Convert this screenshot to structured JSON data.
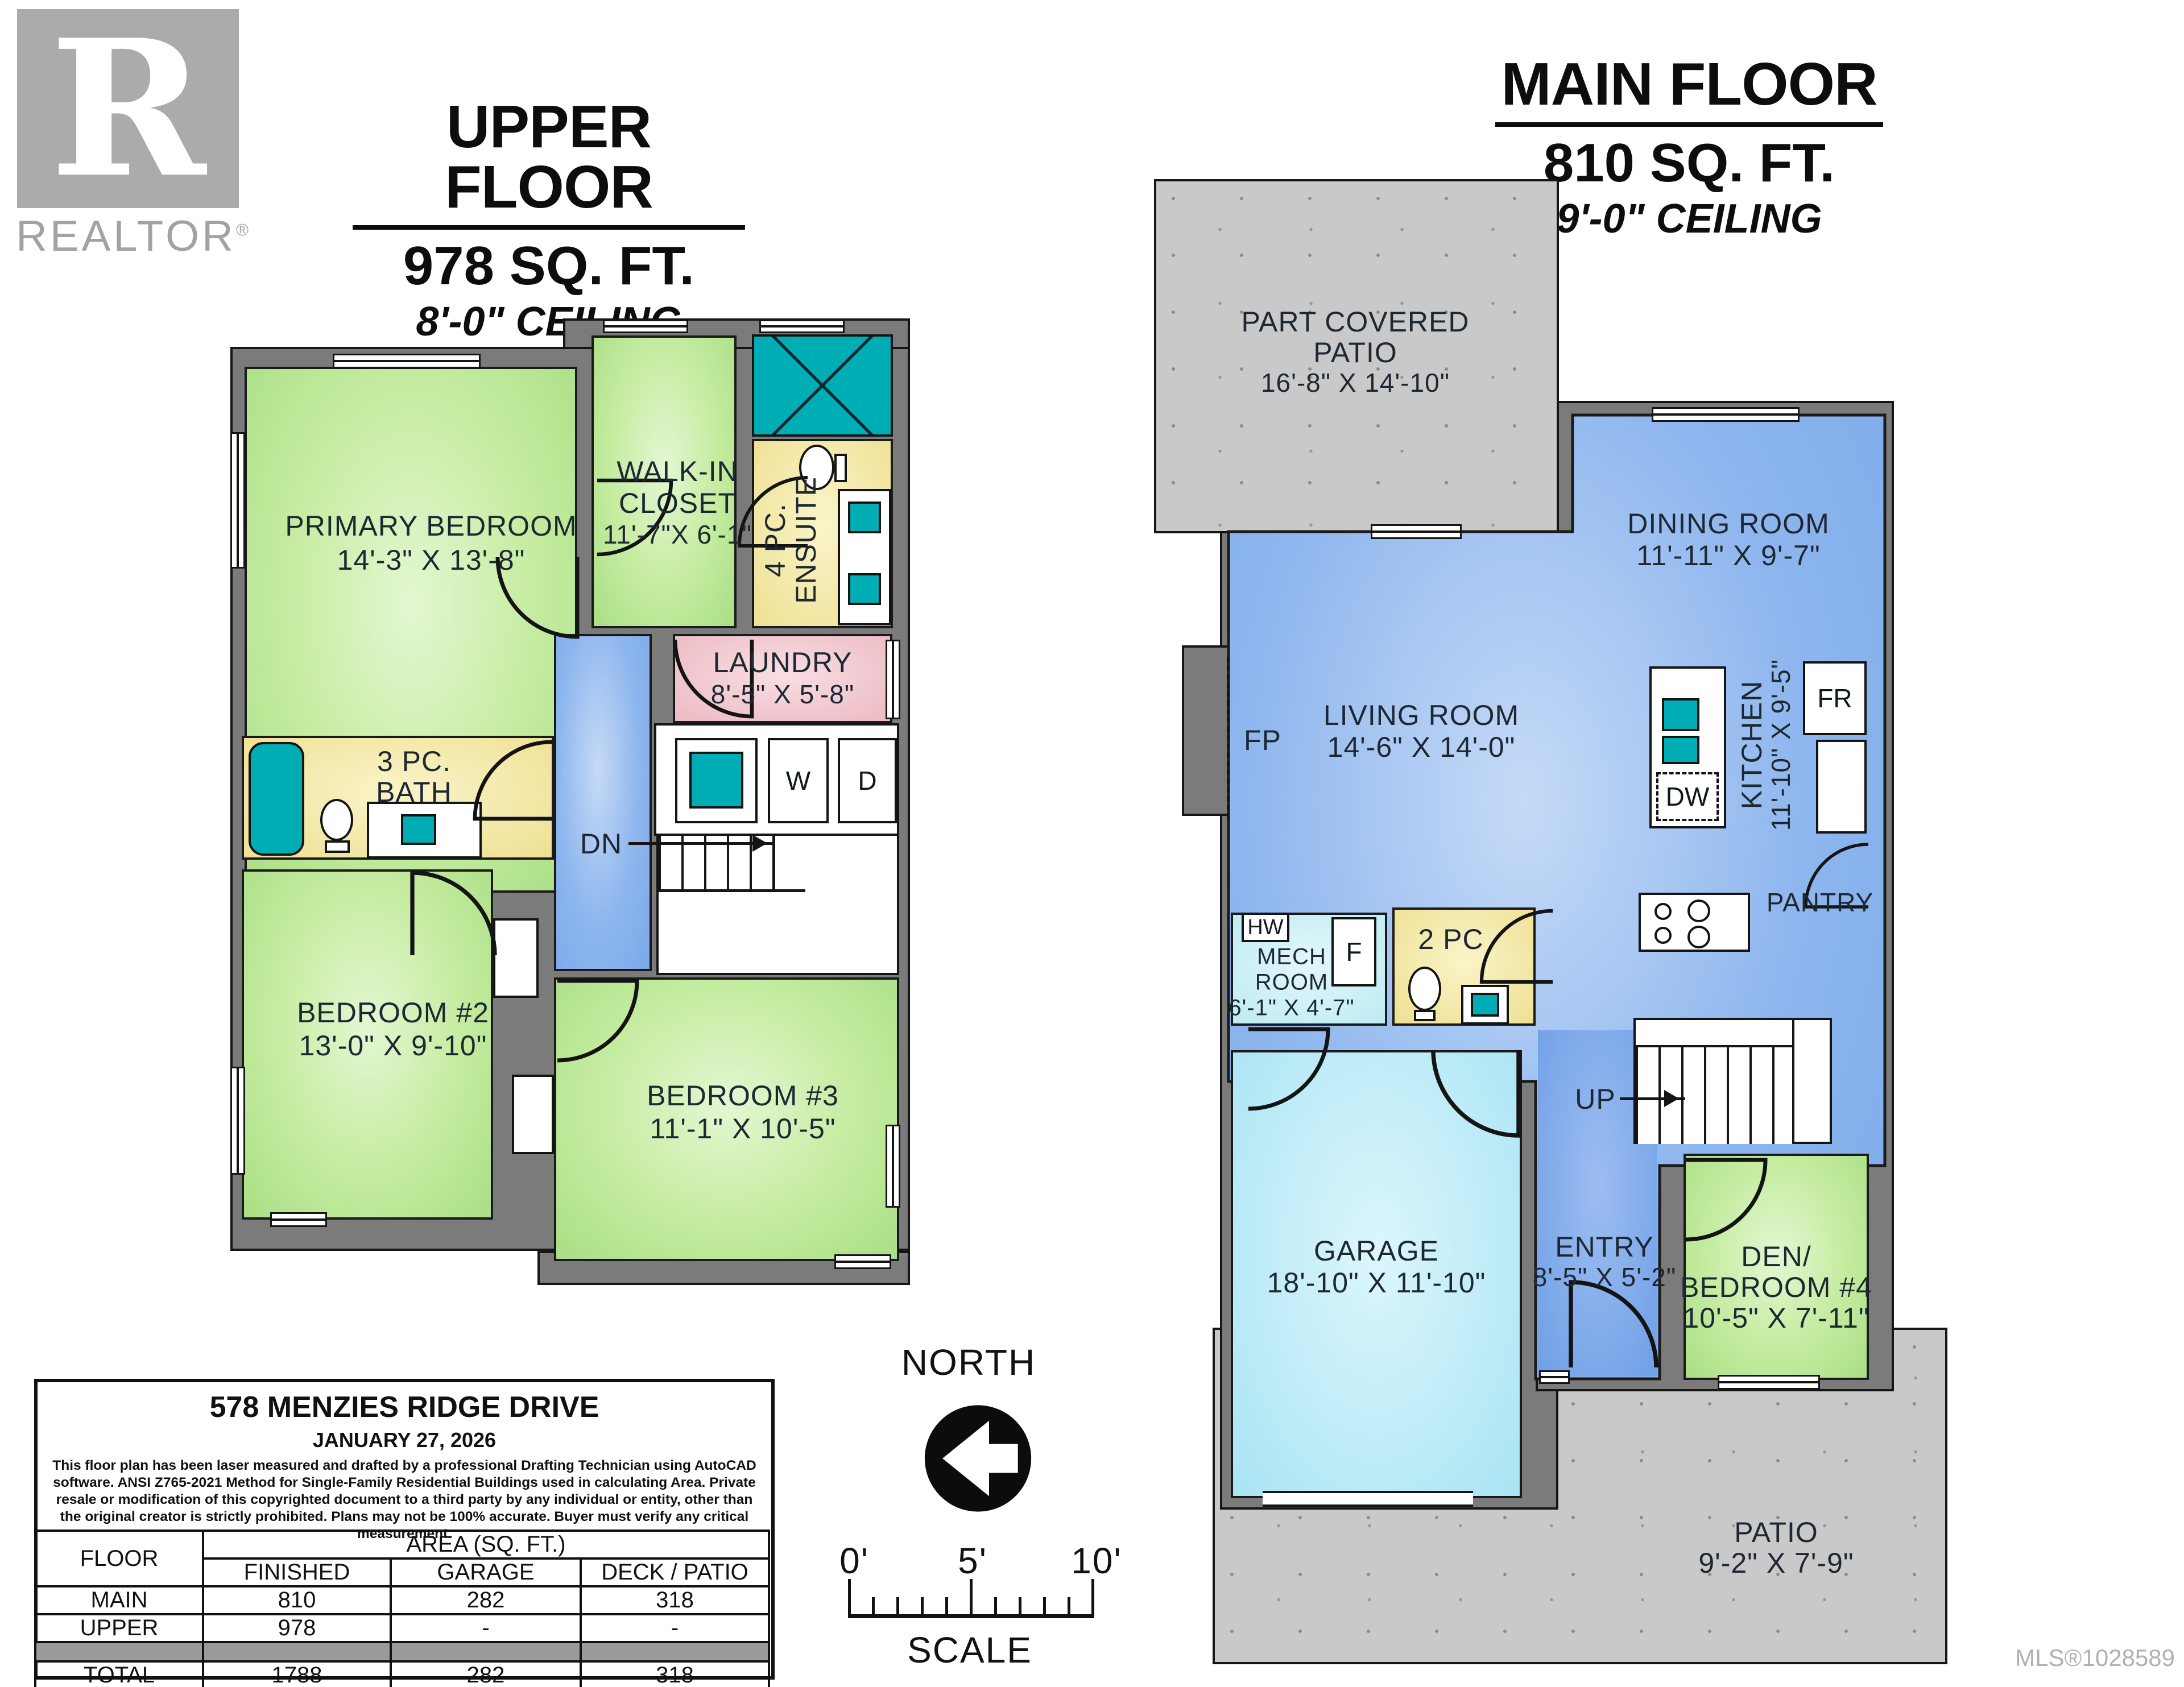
{
  "branding": {
    "logo_letter": "R",
    "brand": "REALTOR",
    "registered": "®"
  },
  "upper": {
    "title": "UPPER FLOOR",
    "area": "978 SQ. FT.",
    "ceiling": "8'-0\" CEILING",
    "rooms": {
      "primary": {
        "name": "PRIMARY BEDROOM",
        "dims": "14'-3\" X 13'-8\""
      },
      "walkin": {
        "line1": "WALK-IN",
        "line2": "CLOSET",
        "dims": "11'-7\"X 6'-1\""
      },
      "ensuite": {
        "line1": "4 PC.",
        "line2": "ENSUITE"
      },
      "laundry": {
        "name": "LAUNDRY",
        "dims": "8'-5\" X 5'-8\""
      },
      "bath": {
        "line1": "3 PC.",
        "line2": "BATH"
      },
      "bedroom2": {
        "name": "BEDROOM #2",
        "dims": "13'-0\" X 9'-10\""
      },
      "bedroom3": {
        "name": "BEDROOM #3",
        "dims": "11'-1\" X 10'-5\""
      }
    },
    "labels": {
      "down": "DN",
      "washer": "W",
      "dryer": "D"
    }
  },
  "main": {
    "title": "MAIN FLOOR",
    "area": "810 SQ. FT.",
    "ceiling": "9'-0\" CEILING",
    "rooms": {
      "covered_patio": {
        "line1": "PART COVERED",
        "line2": "PATIO",
        "dims": "16'-8\" X 14'-10\""
      },
      "dining": {
        "name": "DINING ROOM",
        "dims": "11'-11\" X 9'-7\""
      },
      "living": {
        "name": "LIVING ROOM",
        "dims": "14'-6\" X 14'-0\""
      },
      "kitchen": {
        "name": "KITCHEN",
        "dims": "11'-10\" X 9'-5\""
      },
      "pantry": {
        "name": "PANTRY"
      },
      "mech": {
        "line1": "MECH",
        "line2": "ROOM",
        "dims": "6'-1\" X 4'-7\""
      },
      "powder": {
        "name": "2 PC"
      },
      "garage": {
        "name": "GARAGE",
        "dims": "18'-10\" X 11'-10\""
      },
      "entry": {
        "name": "ENTRY",
        "dims": "8'-5\" X 5'-2\""
      },
      "den": {
        "line1": "DEN/",
        "line2": "BEDROOM #4",
        "dims": "10'-5\" X 7'-11\""
      },
      "patio": {
        "name": "PATIO",
        "dims": "9'-2\" X 7'-9\""
      }
    },
    "labels": {
      "fireplace": "FP",
      "fridge": "FR",
      "dishwasher": "DW",
      "hot_water": "HW",
      "furnace": "F",
      "up": "UP"
    }
  },
  "info": {
    "address": "578 MENZIES RIDGE DRIVE",
    "date": "JANUARY 27, 2026",
    "disclaimer": "This floor plan has been laser measured and drafted by a professional Drafting Technician using AutoCAD software. ANSI Z765-2021 Method for Single-Family Residential Buildings used in calculating Area. Private resale or modification of this copyrighted document to a third party by any individual or entity, other than the original creator is strictly prohibited. Plans may not be 100% accurate.  Buyer must verify any critical measurement.",
    "table": {
      "floor_header": "FLOOR",
      "area_header": "AREA (SQ. FT.)",
      "col_finished": "FINISHED",
      "col_garage": "GARAGE",
      "col_deck": "DECK / PATIO",
      "rows": [
        {
          "floor": "MAIN",
          "finished": "810",
          "garage": "282",
          "deck": "318"
        },
        {
          "floor": "UPPER",
          "finished": "978",
          "garage": "-",
          "deck": "-"
        }
      ],
      "total": {
        "floor": "TOTAL",
        "finished": "1788",
        "garage": "282",
        "deck": "318"
      }
    }
  },
  "compass": {
    "north": "NORTH",
    "scale": "SCALE",
    "tick0": "0'",
    "tick5": "5'",
    "tick10": "10'"
  },
  "mls": "MLS®1028589",
  "colors": {
    "teal": "#00adb5",
    "wall_gray": "#7b7b7b",
    "bedroom_green": "#b5e595",
    "living_blue": "#83b0ea",
    "garage_cyan": "#a9e2f3",
    "bath_yellow": "#efe193",
    "laundry_pink": "#eebcc4",
    "patio_gray": "#c9c9c9"
  }
}
